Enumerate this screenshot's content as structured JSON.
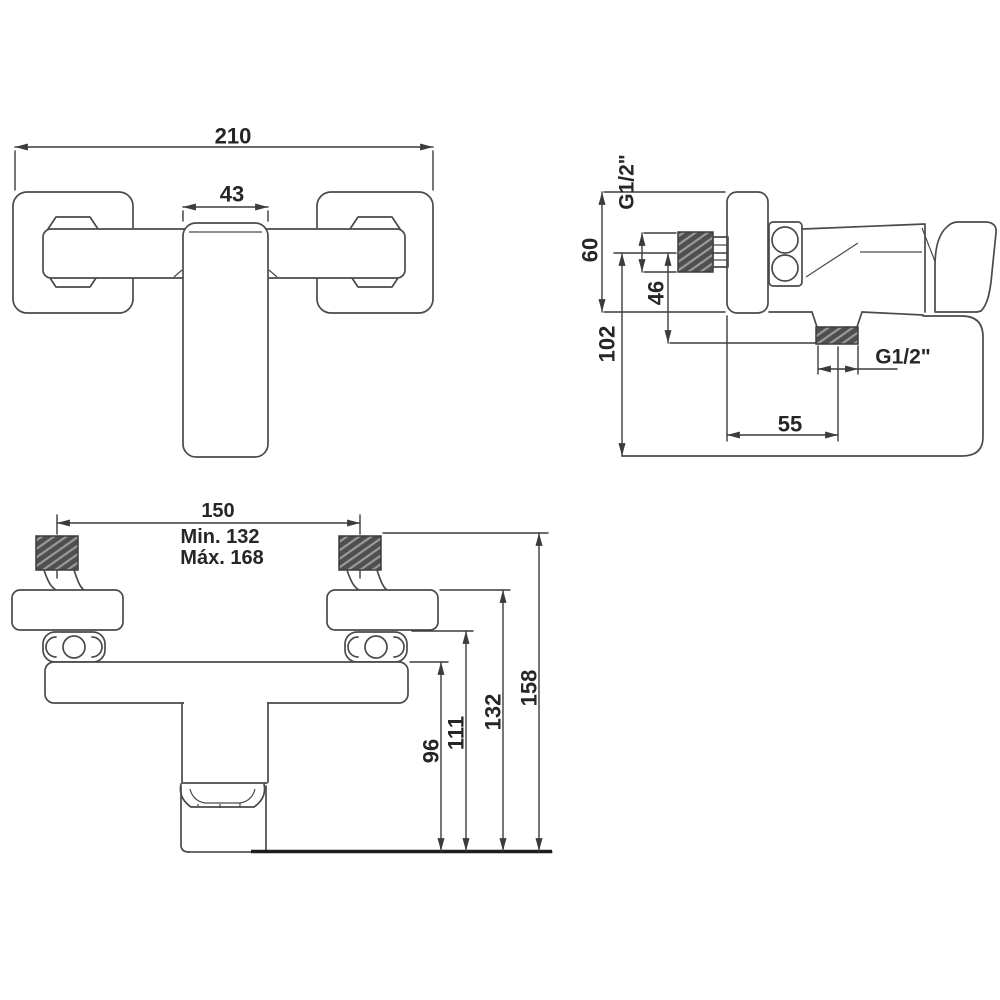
{
  "title": "shower-mixer-dimension-drawing",
  "colors": {
    "background": "#ffffff",
    "ink": "#4a4a4a",
    "dim": "#3c3c3c",
    "text": "#262626",
    "hatch_dark": "#4e4e4e",
    "hatch_light": "#9a9a9a",
    "thick": "#1e1e1e"
  },
  "views": {
    "front": {
      "dim_overall_width": "210",
      "dim_handle_width": "43"
    },
    "side": {
      "inlet_thread_label": "G1/2\"",
      "dim_plate_height": "60",
      "dim_axis_to_outlet": "46",
      "dim_axis_to_bottom": "102",
      "dim_wall_to_outlet": "55",
      "outlet_thread_label": "G1/2\""
    },
    "mounted": {
      "dim_inlet_centers": "150",
      "dim_min": "Min. 132",
      "dim_max": "Máx. 168",
      "dim_body_to_bottom": "96",
      "dim_plate_bottom_to_bottom": "111",
      "dim_plate_top_to_bottom": "132",
      "dim_thread_to_bottom": "158"
    }
  }
}
